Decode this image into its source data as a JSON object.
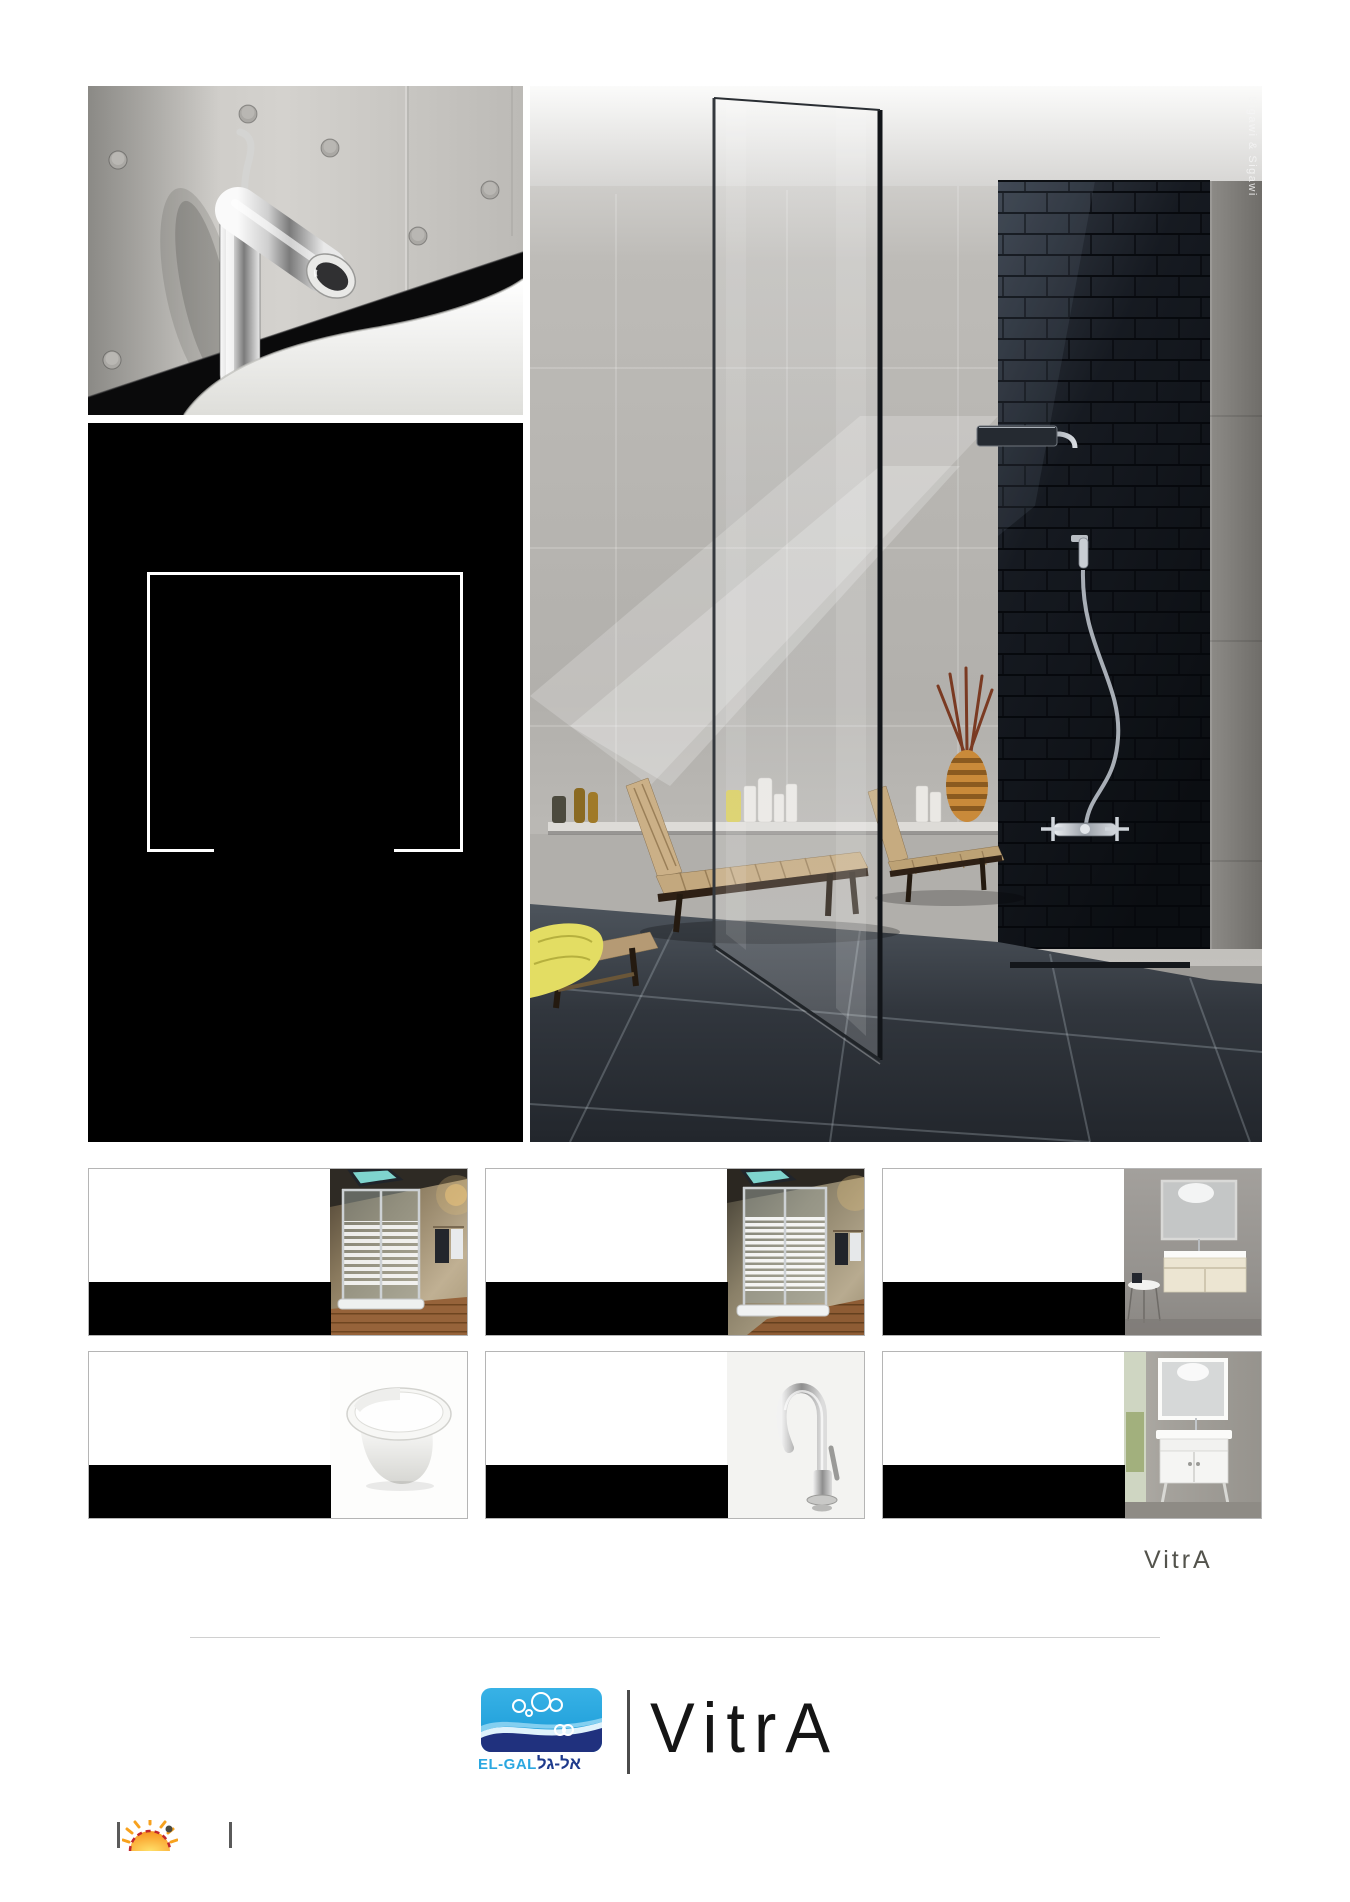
{
  "hero": {
    "credit": "Sigawi & Sigawi"
  },
  "panel": {
    "background": "#000000",
    "frame_color": "#ffffff"
  },
  "cards": [
    {
      "photo": "corner-shower-striped-glass"
    },
    {
      "photo": "shower-cabin-striped-glass"
    },
    {
      "photo": "wall-hung-vanity-with-mirror"
    },
    {
      "photo": "wall-hung-toilet"
    },
    {
      "photo": "gooseneck-basin-mixer"
    },
    {
      "photo": "floor-standing-vanity-with-mirror"
    }
  ],
  "branding": {
    "vitra_small": "VitrA",
    "vitra_large": "VitrA",
    "elgal_latin": "EL-GAL",
    "elgal_hebrew": "אל-גל"
  },
  "colors": {
    "card_bar": "#000000",
    "card_border": "#b5b5b5",
    "elgal_light_blue": "#2aa7e0",
    "elgal_dark_blue": "#1e3a8c",
    "vitra_text": "#151515",
    "divider": "#d0d0d0",
    "sun_orange": "#f7941d",
    "sun_red": "#c1272d"
  }
}
